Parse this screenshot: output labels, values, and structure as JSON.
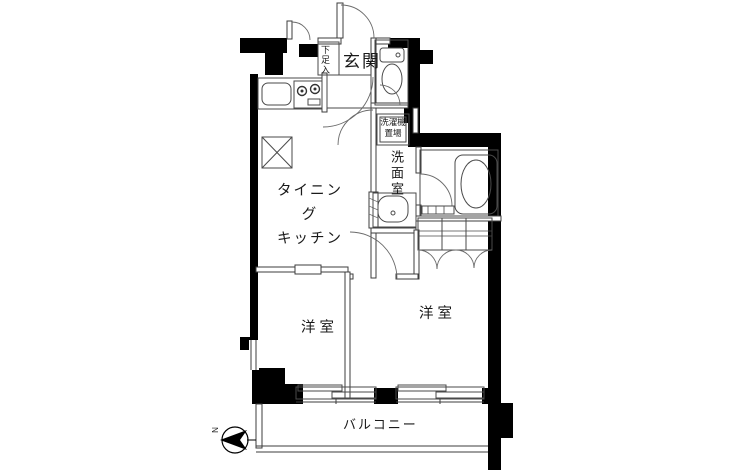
{
  "floorplan": {
    "labels": {
      "genkan": "玄関",
      "shoe_box": "下足入",
      "washer_line1": "洗濯機",
      "washer_line2": "置場",
      "washroom": "洗面室",
      "dk_line1": "タイニング",
      "dk_line2": "キッチン",
      "room_left": "洋室",
      "room_right": "洋室",
      "balcony": "バルコニー",
      "compass_north": "N"
    },
    "colors": {
      "wall": "#000000",
      "thin_line": "#3c3c3c",
      "fixture_line": "#4a4a4a",
      "text": "#1a1a1a",
      "background": "#ffffff"
    }
  }
}
